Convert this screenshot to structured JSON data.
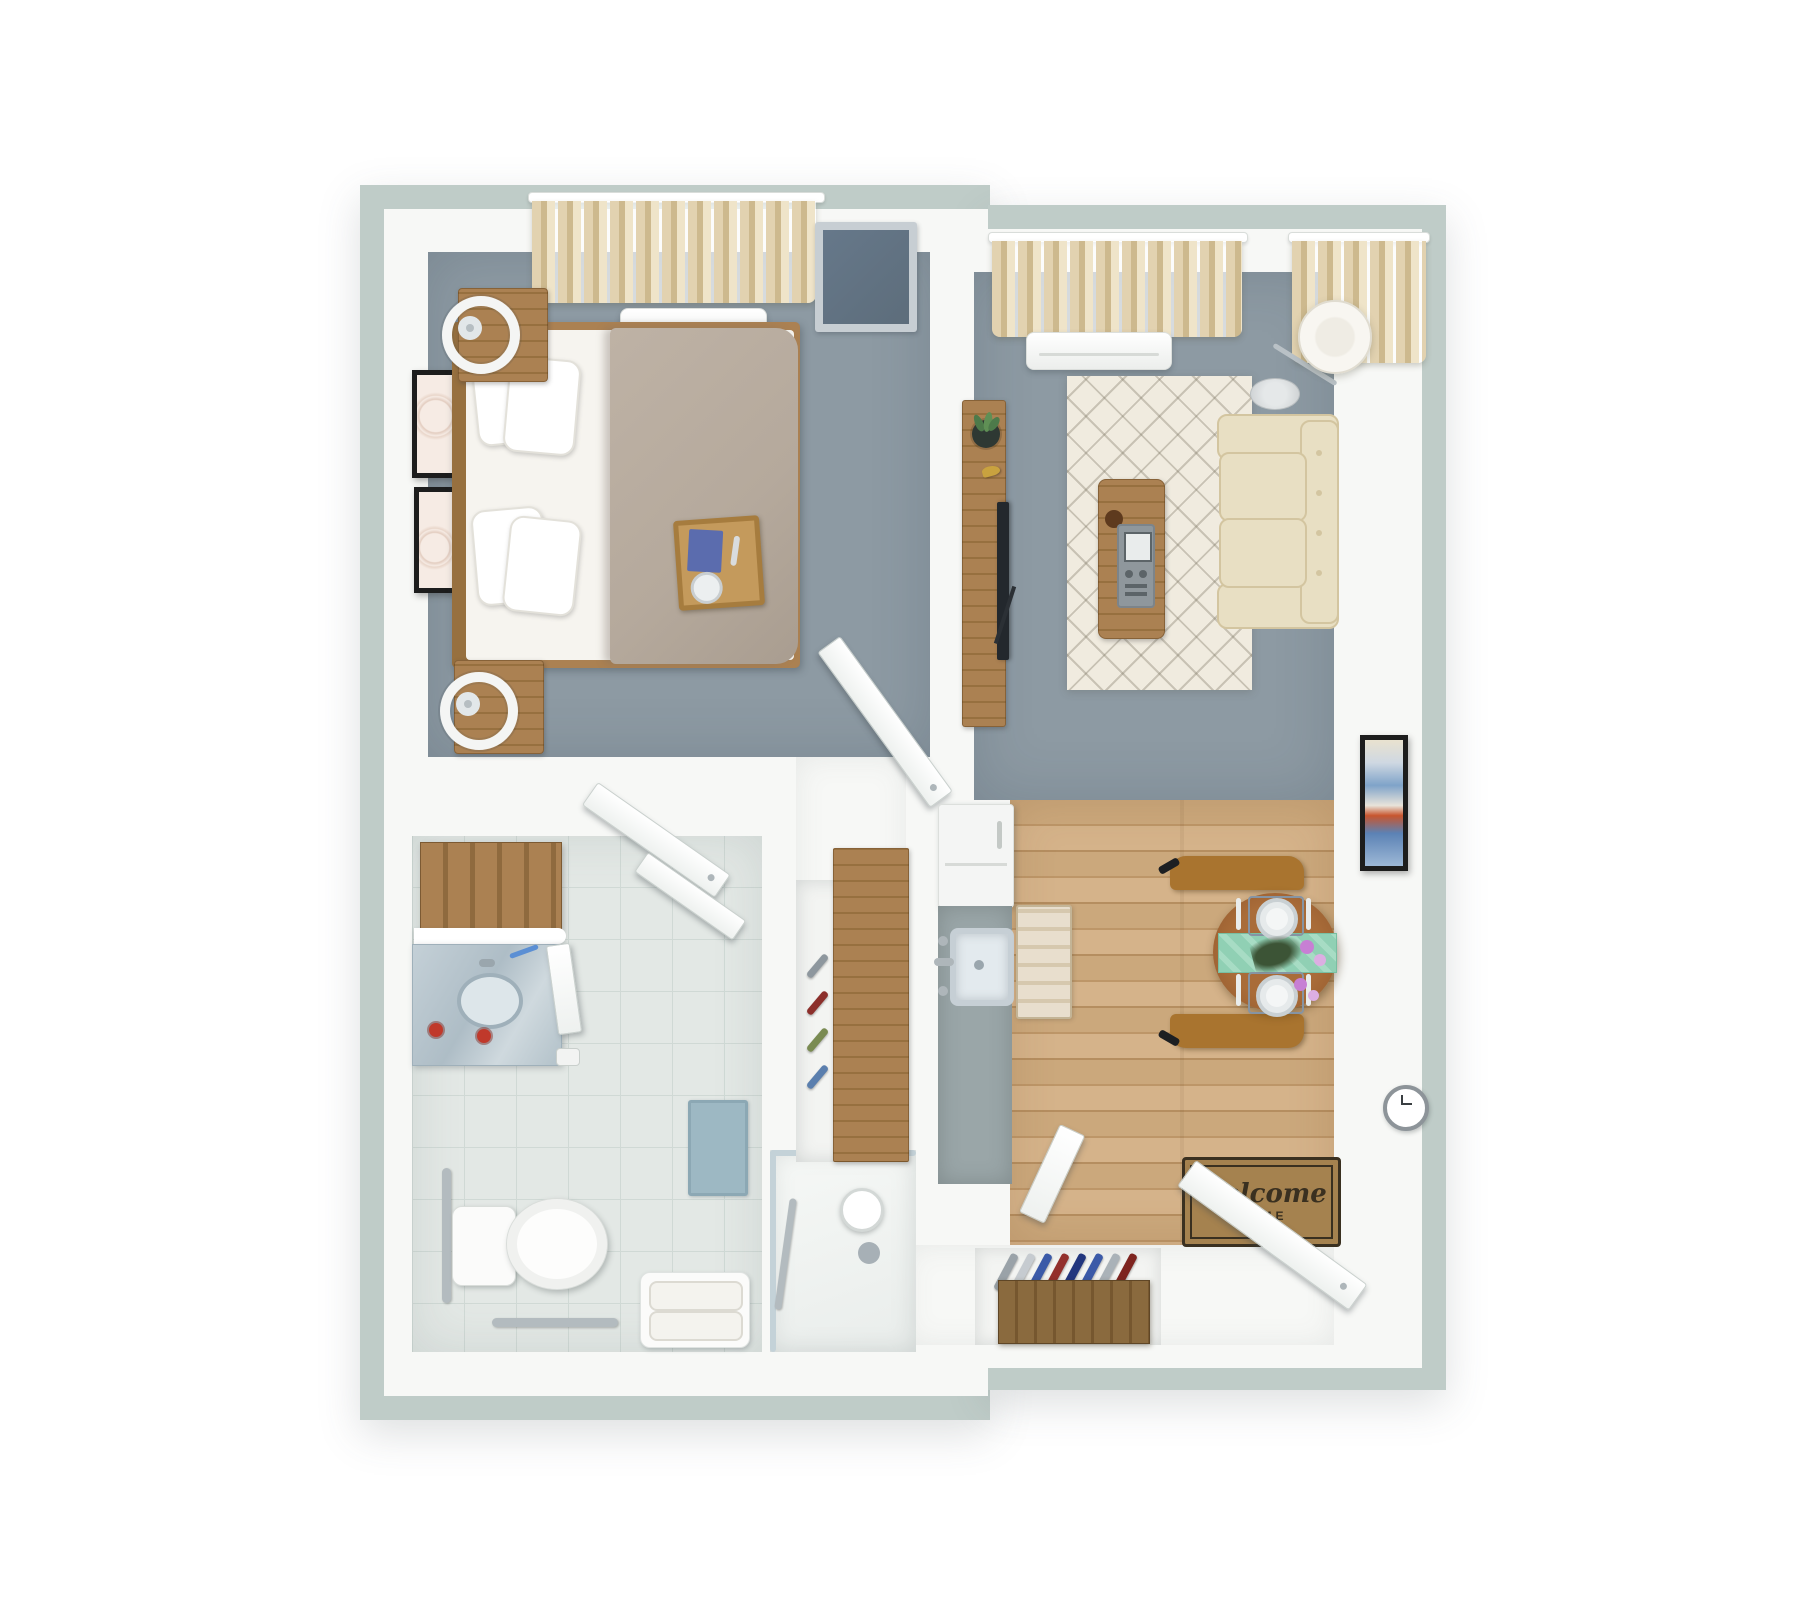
{
  "scene": {
    "description": "3D rendered top-down floor plan of a one-bedroom, one-bathroom apartment with living room, kitchenette, dining nook and entry",
    "background": "#ffffff"
  },
  "palette": {
    "wall_band": "#bfccc8",
    "wall_white": "#f7f8f6",
    "carpet": "#8d9aa3",
    "tile": "#e3e8e5",
    "tile_line": "#d0d9d5",
    "wood_a": "#cba87c",
    "wood_b": "#bd9668",
    "wood_c": "#d5b38a",
    "wood_d": "#b58e60",
    "wood_furn": "#ab8152",
    "wood_furn_dark": "#97703f",
    "counter_gray": "#9aa6a8",
    "appliance_white": "#f4f5f4",
    "sofa": "#e8dfc3",
    "sofa_line": "#d3c5a0",
    "rug": "#f0ebdf",
    "rug_line": "rgba(125,118,100,0.35)",
    "curtain_a": "#e2d2b0",
    "curtain_b": "#cdb98e",
    "curtain_c": "#efe4c9",
    "table_wood": "#9c6132",
    "chair_wood": "#a9742f",
    "runner_mint": "#90d0b4",
    "duvet": "#b5a99c",
    "sheet": "#f6f4ef",
    "dresser_top": "#5d6d7b",
    "dresser_frame": "#c7ced3",
    "mat_bg": "#a5824f",
    "mat_ink": "#3a3020",
    "bathmat": "#9db8c3",
    "glass": "#c4d2d8",
    "metal": "#b9c1c6",
    "tray_wood": "#c49a5c",
    "napkin_blue": "#5b6cae",
    "art_black": "#1d1d1d",
    "plant_green": "#4d7a4a",
    "flower_purple": "#c77fd4",
    "flower_pink": "#dcaee2",
    "leaf_dark": "#3c5436"
  },
  "entry": {
    "doormat": {
      "line1": "Welcome",
      "line2": "HOME"
    },
    "shoe_colors": [
      "#9aa2a8",
      "#c6cbd0",
      "#3b5aa8",
      "#93302c",
      "#22367e",
      "#3b5aa8",
      "#aab2b8",
      "#7e241f"
    ]
  },
  "closet": {
    "shoe_colors": [
      "#8e979e",
      "#8c2f2b",
      "#7a8b52",
      "#5b7fae"
    ]
  },
  "rooms": {
    "bedroom": {
      "items": [
        "double-bed",
        "wood-headboard",
        "white-pillows",
        "taupe-duvet",
        "breakfast-tray",
        "nightstand-x2",
        "ring-lamp-x2",
        "framed-art-x2",
        "curtained-window",
        "ac-unit",
        "dark-dresser",
        "swing-door"
      ]
    },
    "living_room": {
      "items": [
        "tv-console",
        "flatscreen-tv",
        "potted-plant",
        "diamond-rug",
        "coffee-table",
        "remote-tray",
        "cream-sofa",
        "floor-lamp",
        "curtained-windows",
        "ac-unit"
      ]
    },
    "bathroom": {
      "items": [
        "vanity-sink-mirror",
        "toiletry-bottles",
        "wood-shelf-unit",
        "toilet",
        "grab-bar-x2",
        "towel-bench",
        "walk-in-shower",
        "shower-head",
        "blue-bath-mat",
        "swing-doors"
      ]
    },
    "kitchen_dining": {
      "items": [
        "refrigerator",
        "sink-counter",
        "kitchen-runner-rug",
        "round-dining-table",
        "dining-chair-x2",
        "mint-table-runner",
        "place-setting-x2",
        "flower-vase",
        "wall-art",
        "wall-clock"
      ]
    },
    "entry_hall": {
      "items": [
        "welcome-doormat",
        "front-door-open",
        "closet-door",
        "shoe-rack",
        "wardrobe-wood-door",
        "wardrobe-shoes"
      ]
    }
  }
}
